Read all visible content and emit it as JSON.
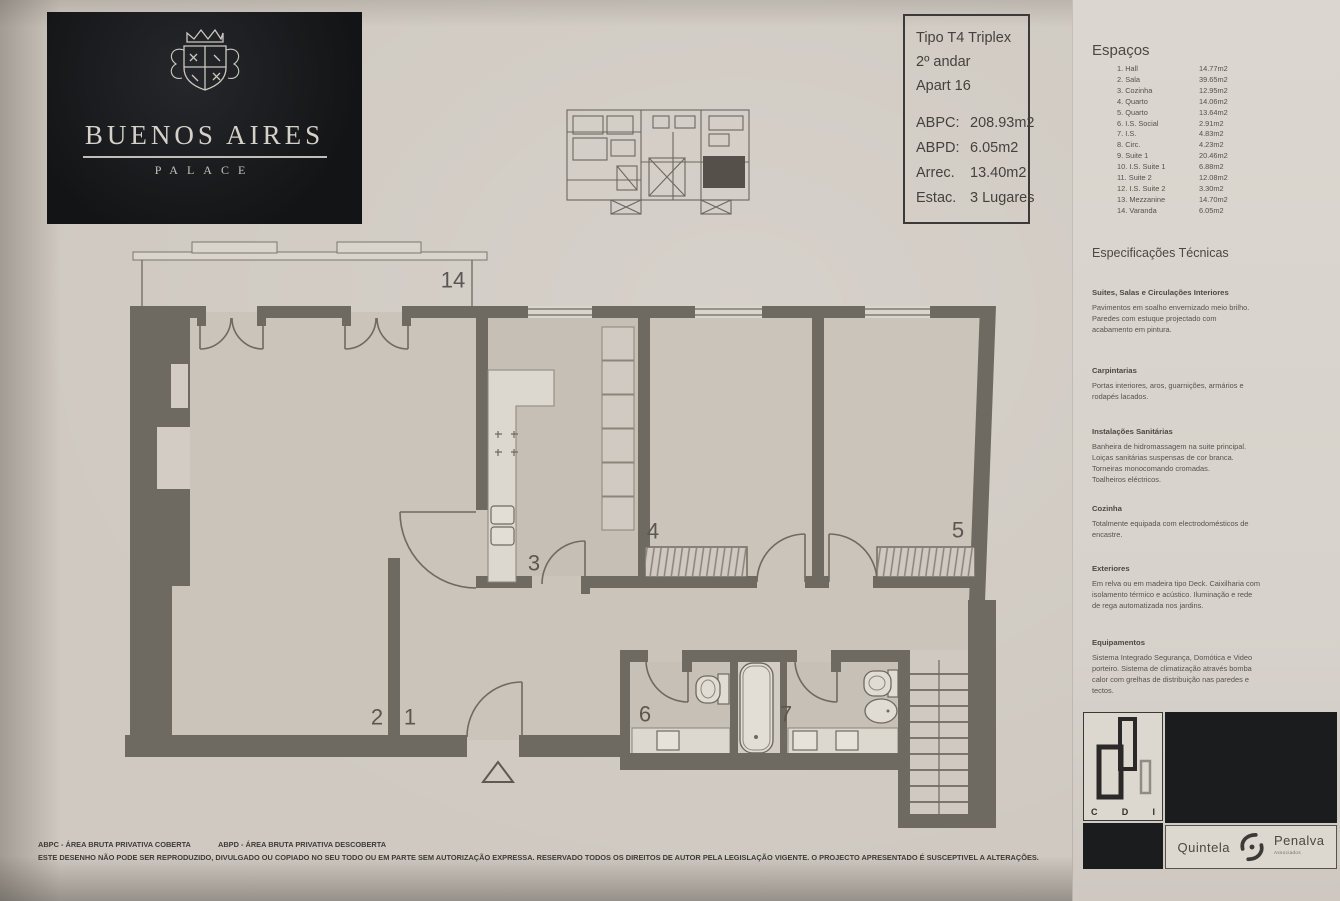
{
  "logo": {
    "title": "BUENOS AIRES",
    "subtitle": "PALACE"
  },
  "info_box": {
    "type_lines": [
      "Tipo T4 Triplex",
      "2º andar",
      "Apart 16"
    ],
    "metrics": [
      {
        "label": "ABPC:",
        "value": "208.93m2"
      },
      {
        "label": "ABPD:",
        "value": "6.05m2"
      },
      {
        "label": "Arrec.",
        "value": "13.40m2"
      },
      {
        "label": "Estac.",
        "value": "3 Lugares"
      }
    ]
  },
  "espacos": {
    "title": "Espaços",
    "rows": [
      {
        "name": "1. Hall",
        "value": "14.77m2"
      },
      {
        "name": "2. Sala",
        "value": "39.65m2"
      },
      {
        "name": "3. Cozinha",
        "value": "12.95m2"
      },
      {
        "name": "4. Quarto",
        "value": "14.06m2"
      },
      {
        "name": "5. Quarto",
        "value": "13.64m2"
      },
      {
        "name": "6. I.S. Social",
        "value": "2.91m2"
      },
      {
        "name": "7. I.S.",
        "value": "4.83m2"
      },
      {
        "name": "8. Circ.",
        "value": "4.23m2"
      },
      {
        "name": "9. Suite 1",
        "value": "20.46m2"
      },
      {
        "name": "10. I.S. Suite 1",
        "value": "6.88m2"
      },
      {
        "name": "11. Suite 2",
        "value": "12.08m2"
      },
      {
        "name": "12. I.S. Suite 2",
        "value": "3.30m2"
      },
      {
        "name": "13. Mezzanine",
        "value": "14.70m2"
      },
      {
        "name": "14. Varanda",
        "value": "6.05m2"
      }
    ]
  },
  "specs": {
    "title": "Especificações Técnicas",
    "sections": [
      {
        "heading": "Suites, Salas e Circulações Interiores",
        "body": "Pavimentos em soalho envernizado meio brilho.\nParedes com estuque projectado com\nacabamento em pintura."
      },
      {
        "heading": "Carpintarias",
        "body": "Portas interiores, aros, guarnições, armários e\nrodapés lacados."
      },
      {
        "heading": "Instalações Sanitárias",
        "body": "Banheira de hidromassagem na suite principal.\nLoiças sanitárias suspensas de cor branca.\nTorneiras monocomando cromadas.\nToalheiros eléctricos."
      },
      {
        "heading": "Cozinha",
        "body": "Totalmente equipada com electrodomésticos de\nencastre."
      },
      {
        "heading": "Exteriores",
        "body": "Em relva ou em madeira tipo Deck. Caixilharia com\nisolamento térmico e acústico. Iluminação e rede\nde rega automatizada nos jardins."
      },
      {
        "heading": "Equipamentos",
        "body": "Sistema Integrado Segurança, Domótica e Video\nporteiro. Sistema de climatização através bomba\ncalor com grelhas de distribuição nas paredes e\ntectos."
      }
    ]
  },
  "plan": {
    "labels": [
      {
        "text": "14",
        "x": 453,
        "y": 282
      },
      {
        "text": "2",
        "x": 377,
        "y": 719
      },
      {
        "text": "1",
        "x": 410,
        "y": 719
      },
      {
        "text": "3",
        "x": 534,
        "y": 565
      },
      {
        "text": "4",
        "x": 653,
        "y": 533
      },
      {
        "text": "5",
        "x": 958,
        "y": 532
      },
      {
        "text": "6",
        "x": 645,
        "y": 716
      },
      {
        "text": "7",
        "x": 786,
        "y": 716
      }
    ]
  },
  "footer": {
    "abbr_left": "ABPC - ÁREA BRUTA PRIVATIVA COBERTA",
    "abbr_right": "ABPD - ÁREA BRUTA PRIVATIVA DESCOBERTA",
    "disclaimer": "ESTE DESENHO NÃO PODE SER REPRODUZIDO, DIVULGADO OU COPIADO NO SEU TODO OU EM PARTE SEM AUTORIZAÇÃO EXPRESSA. RESERVADO TODOS OS DIREITOS DE AUTOR PELA LEGISLAÇÃO VIGENTE. O PROJECTO APRESENTADO É SUSCEPTIVEL A ALTERAÇÕES."
  },
  "brands": {
    "cdi_letters": [
      "C",
      "D",
      "I"
    ],
    "agency_left": "Quintela",
    "agency_right": "Penalva",
    "agency_sub": "Associados"
  },
  "colors": {
    "wall": "#6e6a62",
    "paper": "#d3cec6",
    "logo_bg": "#17181a",
    "border_dark": "#3b3a38"
  }
}
